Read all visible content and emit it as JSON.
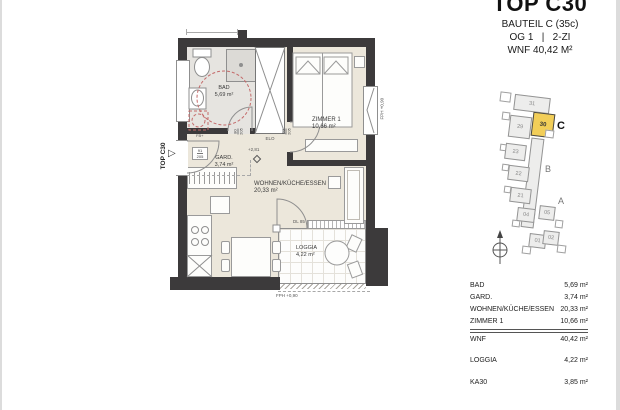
{
  "header": {
    "title": "TOP C30",
    "bauteil": "BAUTEIL C (35c)",
    "floor_line": "OG 1   |   2-ZI",
    "wnf_line": "WNF 40,42 M²"
  },
  "floorplan": {
    "entrance": {
      "marker": "TOP C30"
    },
    "rooms": {
      "bad": {
        "name": "BAD",
        "area": "5,69 m²"
      },
      "gard": {
        "name": "GARD.",
        "area": "3,74 m²"
      },
      "zimmer1": {
        "name": "ZIMMER 1",
        "area": "10,66 m²"
      },
      "wohnen": {
        "name": "WOHNEN/KÜCHE/ESSEN",
        "area": "20,33 m²"
      },
      "loggia": {
        "name": "LOGGIA",
        "area": "4,22 m²"
      }
    },
    "doors": {
      "entrance": {
        "width": "91",
        "height": "205"
      },
      "bad": {
        "width": "80",
        "height": "205"
      },
      "zimmer": {
        "width": "80",
        "height": "205"
      },
      "loggia_label": "DL 85"
    },
    "annotations": {
      "elo": "ELO",
      "fb": "FB+",
      "ceiling_height": "+2,81",
      "window_parapet": "FPH +0,90",
      "loggia_parapet": "FPH +0,90"
    },
    "colors": {
      "wall": "#3c3a3b",
      "floor": "#ece7db",
      "bath_floor": "#e6e4e0",
      "accessory_red": "#c46a6a"
    }
  },
  "keyplan": {
    "units": [
      "31",
      "29",
      "30",
      "23",
      "22",
      "21",
      "04",
      "05",
      "01",
      "02"
    ],
    "highlighted_unit": "30",
    "highlight_color": "#F2CE58",
    "sections": {
      "c": "C",
      "b": "B",
      "a": "A"
    }
  },
  "area_table": {
    "rows": [
      {
        "label": "BAD",
        "value": "5,69 m²"
      },
      {
        "label": "GARD.",
        "value": "3,74 m²"
      },
      {
        "label": "WOHNEN/KÜCHE/ESSEN",
        "value": "20,33 m²"
      },
      {
        "label": "ZIMMER 1",
        "value": "10,66 m²"
      }
    ],
    "wnf": {
      "label": "WNF",
      "value": "40,42 m²"
    },
    "loggia": {
      "label": "LOGGIA",
      "value": "4,22 m²"
    },
    "ka": {
      "label": "KA30",
      "value": "3,85 m²"
    }
  }
}
